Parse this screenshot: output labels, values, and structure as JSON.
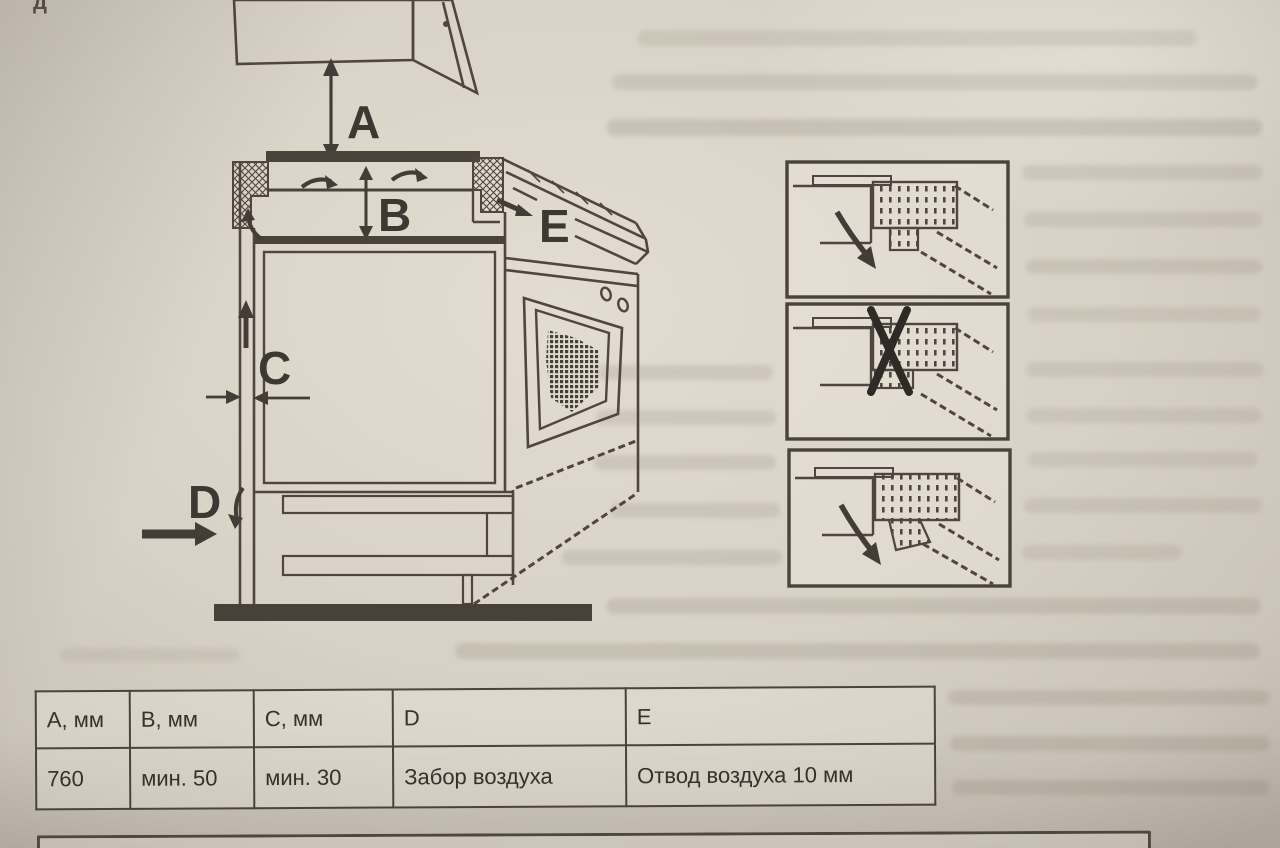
{
  "page": {
    "corner_fragment": "д"
  },
  "diagram": {
    "labels": {
      "a": "A",
      "b": "B",
      "c": "C",
      "d": "D",
      "e": "E"
    }
  },
  "table": {
    "headers": [
      "A, мм",
      "B, мм",
      "C, мм",
      "D",
      "E"
    ],
    "values": [
      "760",
      "мин. 50",
      "мин. 30",
      "Забор воздуха",
      "Отвод воздуха 10 мм"
    ]
  },
  "colors": {
    "paper": "#d6d0c4",
    "ink": "#4e463f"
  }
}
